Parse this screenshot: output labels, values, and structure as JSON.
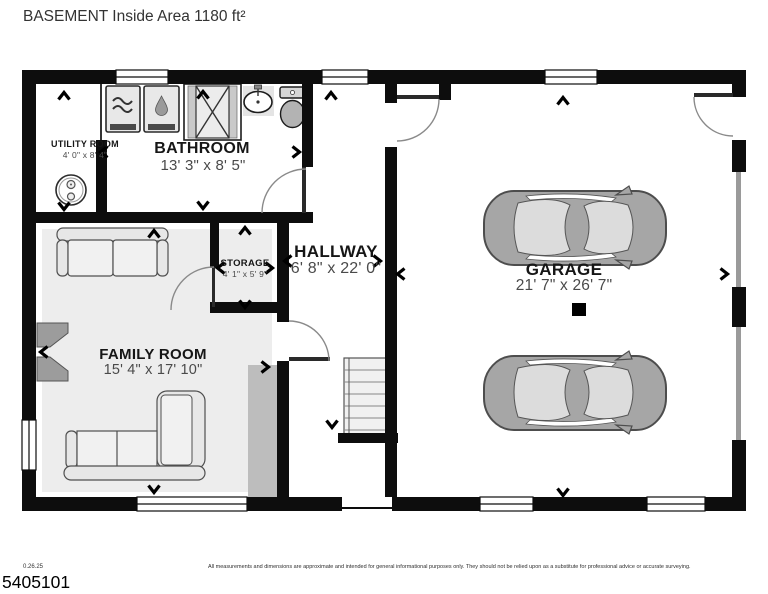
{
  "title": "BASEMENT Inside Area 1180 ft²",
  "rooms": {
    "utility": {
      "name": "UTILITY ROOM",
      "dims": "4' 0\" x 8' 4\""
    },
    "bathroom": {
      "name": "BATHROOM",
      "dims": "13' 3\" x 8' 5\""
    },
    "storage": {
      "name": "STORAGE",
      "dims": "4' 1\" x 5' 9\""
    },
    "hallway": {
      "name": "HALLWAY",
      "dims": "6' 8\" x 22' 0\""
    },
    "family": {
      "name": "FAMILY ROOM",
      "dims": "15' 4\" x 17' 10\""
    },
    "garage": {
      "name": "GARAGE",
      "dims": "21' 7\" x 26' 7\""
    }
  },
  "footer": {
    "date": "0.26.25",
    "id": "5405101",
    "disclaimer": "All measurements and dimensions are approximate and intended for general informational purposes only. They should not be relied upon as a substitute for professional advice or accurate surveying."
  },
  "icons": {
    "washer": "washer-icon",
    "dryer": "dryer-icon",
    "shower": "shower-icon",
    "sink": "sink-icon",
    "toilet": "toilet-icon",
    "water_heater": "water-heater-icon",
    "sofa": "sofa-icon",
    "sectional_sofa": "sectional-sofa-icon",
    "stairs": "stairs-icon",
    "car": "car-icon",
    "fireplace": "fireplace-icon",
    "support_post": "support-post-icon",
    "dimension_arrow": "dimension-arrow-icon"
  },
  "colors": {
    "wall": "#0d0d0d",
    "family_floor": "#ededed",
    "chimney": "#bdbdbd",
    "garage_door": "#9a9a9a",
    "car_body": "#a6a6a6",
    "fixture_gray": "#c9c9c9"
  }
}
